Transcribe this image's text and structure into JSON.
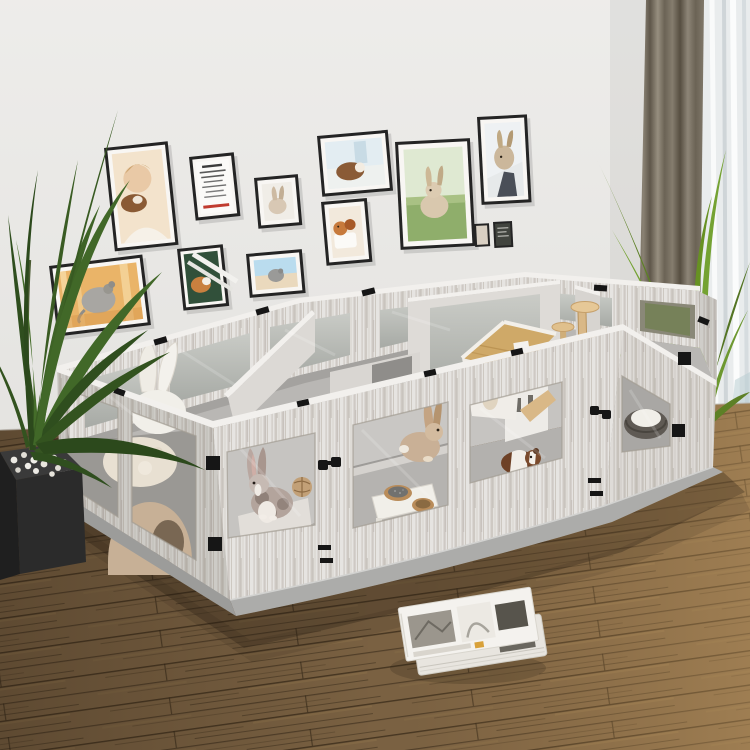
{
  "scene": {
    "type": "product-lifestyle-photo",
    "subject": "DIY small-animal playpen with clear acrylic windows in a living room",
    "setting": "living room with pet-photo gallery wall, palm plants, curtains and wood plank floor"
  },
  "palette": {
    "wall": "#e9e8e5",
    "floor_base": "#7a6142",
    "pen_wood_base": "#e6e4e1",
    "pen_top_edge": "#f2f0ed",
    "acrylic_window": "#b7bab4",
    "interior_floor": "#b9b7b4",
    "base_plate": "#acacaa",
    "hardware_black": "#161616",
    "curtain_taupe": "#7a7265",
    "sheer_white": "#e9eced",
    "palm_dark_green": "#3e6326",
    "palm_bright_green": "#74a232",
    "shadow_brown": "#231b12"
  },
  "gallery_wall": {
    "frames": [
      {
        "id": "frame-child-guinea-pig",
        "subject": "child kissing a guinea pig"
      },
      {
        "id": "frame-text-poster",
        "subject": "pet text poster with red accent line"
      },
      {
        "id": "frame-white-rabbit",
        "subject": "rabbit on white background"
      },
      {
        "id": "frame-guinea-pig-window",
        "subject": "guinea pig beside a bright window"
      },
      {
        "id": "frame-hamsters-cup",
        "subject": "hamsters with a white cup"
      },
      {
        "id": "frame-guinea-pig-greens",
        "subject": "guinea pig on greens with white diagonal stripes"
      },
      {
        "id": "frame-chinchilla-beach",
        "subject": "chinchilla on sand under blue sky"
      },
      {
        "id": "frame-chinchilla-orange",
        "subject": "chinchilla in warm orange light"
      },
      {
        "id": "frame-bunny-grass",
        "subject": "bunny sitting on green grass"
      },
      {
        "id": "frame-rabbit-held",
        "subject": "rabbit held up by its owner"
      },
      {
        "id": "frame-mini-beige",
        "subject": "small beige print"
      },
      {
        "id": "frame-mini-dark",
        "subject": "small dark print"
      }
    ]
  },
  "playpen": {
    "material": "washed gray wood-grain panels",
    "window_type": "clear acrylic panels",
    "base": "gray mat base plates",
    "hardware": "black corner locks and double hinges",
    "rooms": [
      {
        "id": "room-cushion",
        "contents": [
          "bunny-ear pillow",
          "fleece blanket",
          "cave bed"
        ]
      },
      {
        "id": "room-spotted-rabbit",
        "contents": [
          "spotted rabbit",
          "woven chew ball",
          "white step mats"
        ]
      },
      {
        "id": "room-beige-rabbit",
        "contents": [
          "beige rabbit",
          "wood platform",
          "feeding tray with two bowls"
        ]
      },
      {
        "id": "room-guinea-pig",
        "contents": [
          "guinea pig",
          "chew ball",
          "A-frame pet house",
          "cat tree",
          "wood ramp"
        ]
      },
      {
        "id": "room-pet-bed",
        "contents": [
          "round pet bed",
          "woven basket"
        ]
      }
    ]
  },
  "plants": [
    {
      "id": "left-palm",
      "pot": "black planter with white pebbles"
    },
    {
      "id": "right-palm",
      "pot": "dark pot behind playpen"
    }
  ],
  "window_area": {
    "curtain": "taupe floor-length curtain",
    "sheer": "white sheer with daylight"
  },
  "floor": {
    "type": "rustic wood planks",
    "tone_left": "dark walnut",
    "tone_right": "warm oak"
  },
  "accessories": {
    "magazines_on_floor": 2
  }
}
